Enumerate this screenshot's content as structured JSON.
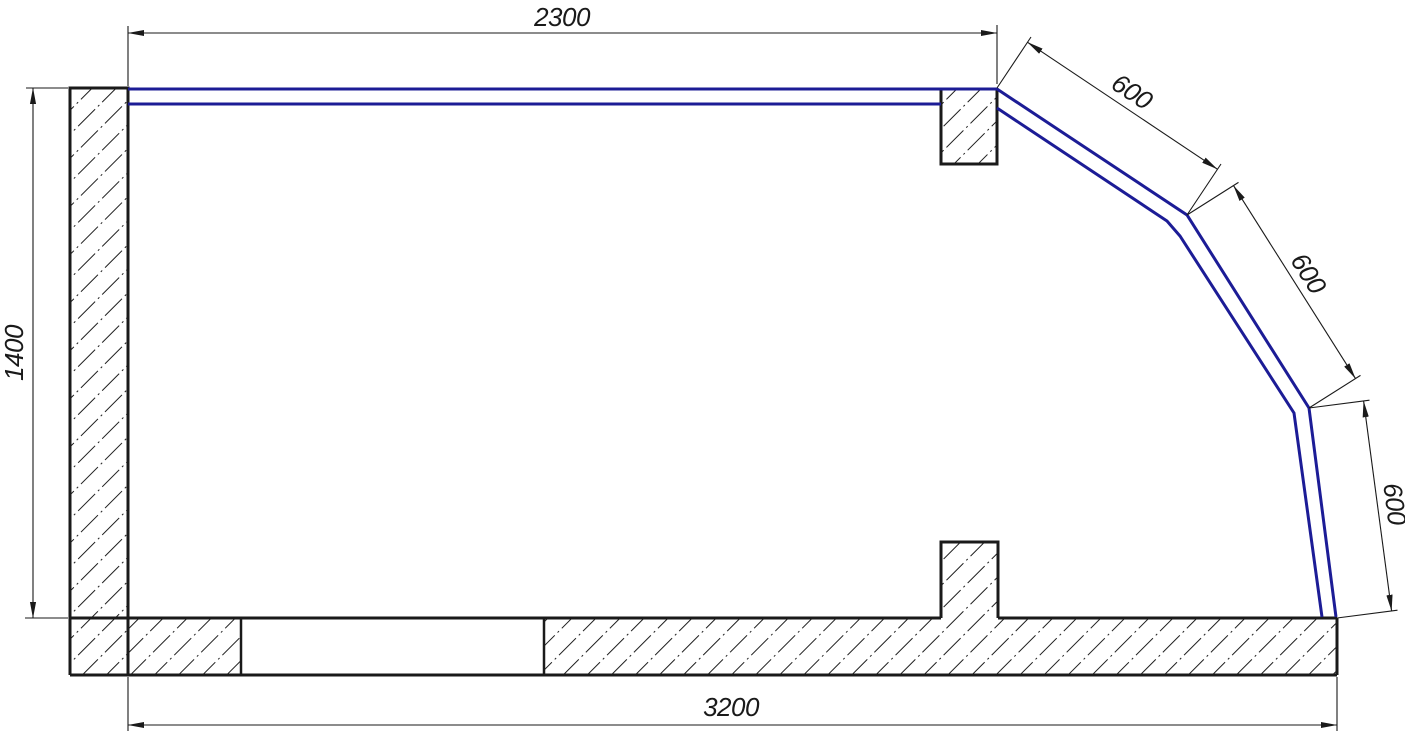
{
  "drawing": {
    "type": "cad-section-drawing",
    "colors": {
      "outline": "#1a1a1a",
      "profile_line": "#1c1c96",
      "background": "#ffffff"
    },
    "dimensions": {
      "top_width": "2300",
      "left_height": "1400",
      "bottom_width": "3200",
      "slant_upper": "600",
      "slant_middle": "600",
      "slant_lower": "600"
    }
  }
}
